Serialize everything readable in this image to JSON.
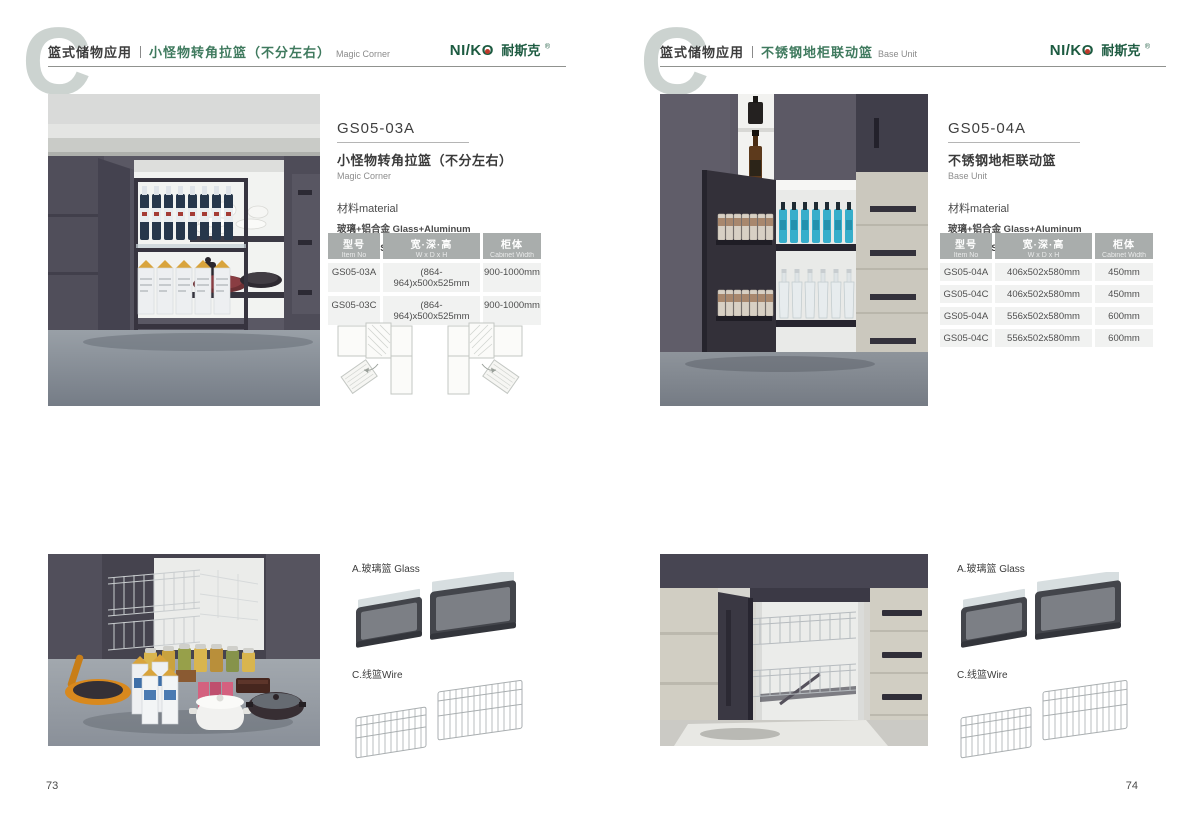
{
  "brand": {
    "latin_left": "NI/K",
    "latin_o": "O",
    "cn": "耐斯克",
    "reg": "®",
    "color": "#1d5b41"
  },
  "pages": [
    {
      "page_number": "73",
      "header": {
        "category": "篮式储物应用",
        "title_cn": "小怪物转角拉篮（不分左右）",
        "title_en": "Magic Corner"
      },
      "product": {
        "model": "GS05-03A",
        "name_cn": "小怪物转角拉篮（不分左右）",
        "name_en": "Magic Corner",
        "material_label": "材料material",
        "material_1": "玻璃+铝合金 Glass+Aluminum",
        "material_2": "不锈钢/铁 Stainless SteeL/Iron"
      },
      "table": {
        "headers": [
          {
            "cn": "型号",
            "en": "Item No"
          },
          {
            "cn": "宽·深·高",
            "en": "W x D x H"
          },
          {
            "cn": "柜体",
            "en": "Cabinet Width"
          }
        ],
        "rows": [
          [
            "GS05-03A",
            "(864-964)x500x525mm",
            "900-1000mm"
          ],
          [
            "GS05-03C",
            "(864-964)x500x525mm",
            "900-1000mm"
          ]
        ]
      },
      "labels": {
        "glass": "A.玻璃篮 Glass",
        "wire": "C.线篮Wire"
      }
    },
    {
      "page_number": "74",
      "header": {
        "category": "篮式储物应用",
        "title_cn": "不锈钢地柜联动篮",
        "title_en": "Base Unit"
      },
      "product": {
        "model": "GS05-04A",
        "name_cn": "不锈钢地柜联动篮",
        "name_en": "Base Unit",
        "material_label": "材料material",
        "material_1": "玻璃+铝合金 Glass+Aluminum",
        "material_2": "不锈钢/铁 Stainless SteeL/Iron"
      },
      "table": {
        "headers": [
          {
            "cn": "型号",
            "en": "Item No"
          },
          {
            "cn": "宽·深·高",
            "en": "W x D x H"
          },
          {
            "cn": "柜体",
            "en": "Cabinet Width"
          }
        ],
        "rows": [
          [
            "GS05-04A",
            "406x502x580mm",
            "450mm"
          ],
          [
            "GS05-04C",
            "406x502x580mm",
            "450mm"
          ],
          [
            "GS05-04A",
            "556x502x580mm",
            "600mm"
          ],
          [
            "GS05-04C",
            "556x502x580mm",
            "600mm"
          ]
        ]
      },
      "labels": {
        "glass": "A.玻璃篮 Glass",
        "wire": "C.线篮Wire"
      }
    }
  ]
}
